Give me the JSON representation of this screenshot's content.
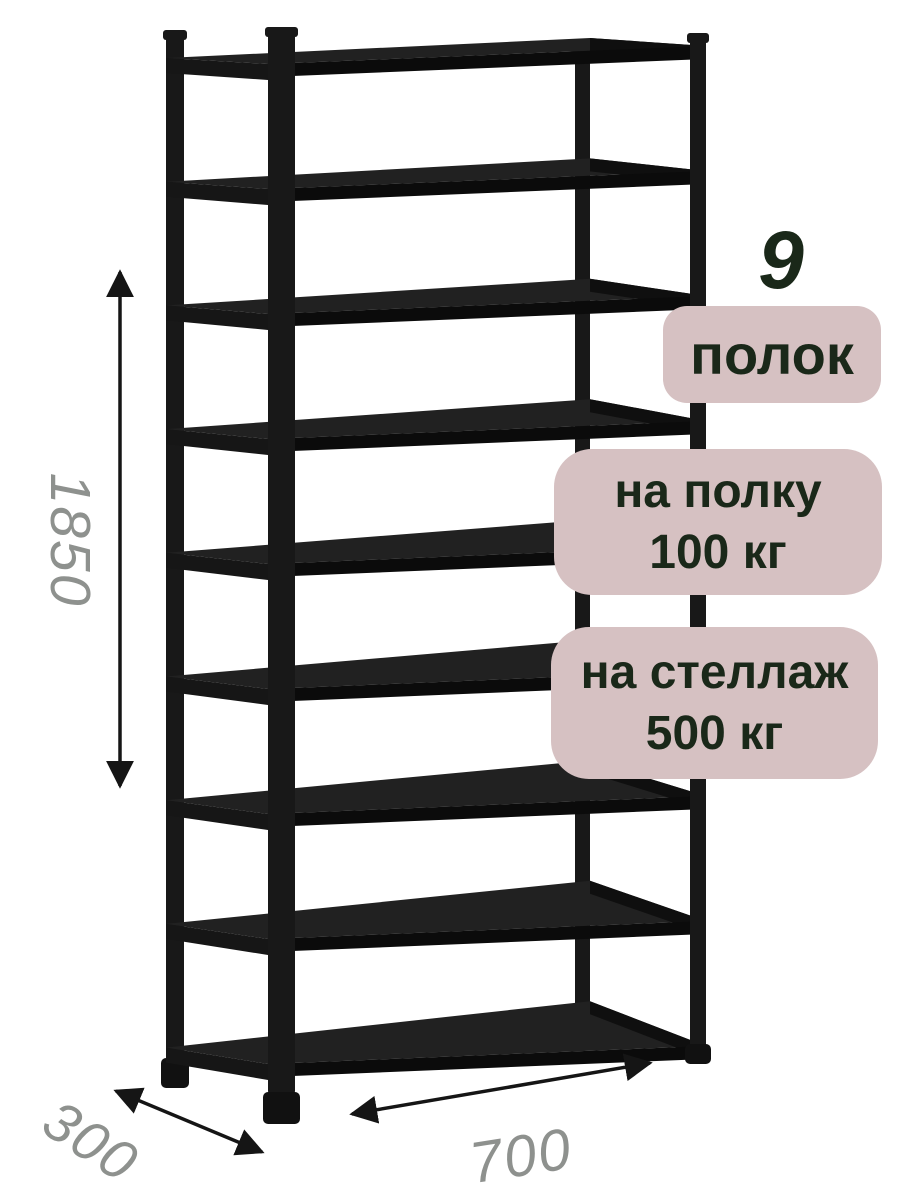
{
  "product": {
    "kind": "metal-shelving-rack-render",
    "shelf_count": 9
  },
  "dimensions": {
    "height_mm": "1850",
    "depth_mm": "300",
    "width_mm": "700"
  },
  "callouts": {
    "count_number": "9",
    "count_label": "полок",
    "shelf_load": {
      "line1": "на полку",
      "line2": "100 кг"
    },
    "rack_load": {
      "line1": "на стеллаж",
      "line2": "500 кг"
    }
  },
  "colors": {
    "page_background": "#ffffff",
    "badge_background": "#d6c1c2",
    "callout_text": "#1a2819",
    "dimension_text": "#8e918e",
    "arrow": "#151515",
    "rack_post": "#181818",
    "rack_shelf_top": "#212121",
    "rack_shelf_front": "#0b0b0b",
    "rack_shelf_left": "#161616",
    "rack_shelf_right": "#0f0f0f",
    "rack_foot": "#111111"
  }
}
